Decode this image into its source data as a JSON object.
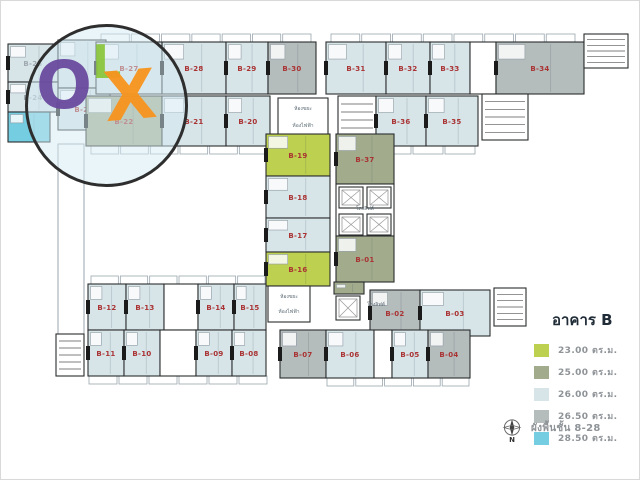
{
  "colors": {
    "sqm_23": "#bdd04f",
    "sqm_25": "#a2ac8d",
    "sqm_26": "#d7e5e9",
    "sqm_265": "#b5bcbc",
    "sqm_285": "#74cde1",
    "wall": "#2a2d2e",
    "unit_label_red": "#a93232",
    "unit_label_gray": "#9fa8b0",
    "tiny_text": "#5a6a74",
    "legend_text": "#8e9397",
    "legend_title": "#1f2b36",
    "olx_purple": "#6a4a9e",
    "olx_green": "#8cc63e",
    "olx_orange": "#f7941e",
    "background": "#ffffff"
  },
  "watermark": {
    "o": "O",
    "l": "L",
    "x": "X"
  },
  "legend": {
    "title": "อาคาร B",
    "items": [
      {
        "t": "23",
        "label": "23.00 ตร.ม."
      },
      {
        "t": "25",
        "label": "25.00 ตร.ม."
      },
      {
        "t": "26",
        "label": "26.00 ตร.ม."
      },
      {
        "t": "265",
        "label": "26.50 ตร.ม."
      },
      {
        "t": "285",
        "label": "28.50 ตร.ม."
      }
    ]
  },
  "footer": {
    "north": "N",
    "caption": "ผังพื้นชั้น 8-28"
  },
  "plan": {
    "units": [
      {
        "id": "B-25",
        "x": 8,
        "y": 44,
        "w": 50,
        "h": 38,
        "t": "26",
        "lc": "gray"
      },
      {
        "x": 58,
        "y": 40,
        "w": 48,
        "h": 48,
        "t": "26"
      },
      {
        "id": "B-24",
        "x": 8,
        "y": 82,
        "w": 50,
        "h": 30,
        "t": "26",
        "lc": "gray"
      },
      {
        "id": "B-23",
        "x": 58,
        "y": 88,
        "w": 52,
        "h": 42,
        "t": "26"
      },
      {
        "x": 8,
        "y": 112,
        "w": 42,
        "h": 30,
        "t": "285"
      },
      {
        "id": "B-27",
        "x": 96,
        "y": 42,
        "w": 66,
        "h": 52,
        "t": "26"
      },
      {
        "id": "B-28",
        "x": 162,
        "y": 42,
        "w": 64,
        "h": 52,
        "t": "26"
      },
      {
        "id": "B-29",
        "x": 226,
        "y": 42,
        "w": 42,
        "h": 52,
        "t": "26"
      },
      {
        "id": "B-30",
        "x": 268,
        "y": 42,
        "w": 48,
        "h": 52,
        "t": "265"
      },
      {
        "id": "B-31",
        "x": 326,
        "y": 42,
        "w": 60,
        "h": 52,
        "t": "26"
      },
      {
        "id": "B-32",
        "x": 386,
        "y": 42,
        "w": 44,
        "h": 52,
        "t": "26"
      },
      {
        "id": "B-33",
        "x": 430,
        "y": 42,
        "w": 40,
        "h": 52,
        "t": "26"
      },
      {
        "x": 470,
        "y": 42,
        "w": 26,
        "h": 52,
        "t": "room"
      },
      {
        "id": "B-34",
        "x": 496,
        "y": 42,
        "w": 88,
        "h": 52,
        "t": "265"
      },
      {
        "x": 584,
        "y": 34,
        "w": 44,
        "h": 34,
        "t": "stair"
      },
      {
        "id": "B-22",
        "x": 86,
        "y": 96,
        "w": 76,
        "h": 50,
        "t": "25"
      },
      {
        "id": "B-21",
        "x": 162,
        "y": 96,
        "w": 64,
        "h": 50,
        "t": "26"
      },
      {
        "id": "B-20",
        "x": 226,
        "y": 96,
        "w": 44,
        "h": 50,
        "t": "26"
      },
      {
        "x": 278,
        "y": 98,
        "w": 50,
        "h": 42,
        "t": "room"
      },
      {
        "x": 338,
        "y": 96,
        "w": 38,
        "h": 48,
        "t": "stair"
      },
      {
        "id": "B-36",
        "x": 376,
        "y": 96,
        "w": 50,
        "h": 50,
        "t": "26"
      },
      {
        "id": "B-35",
        "x": 426,
        "y": 96,
        "w": 52,
        "h": 50,
        "t": "26"
      },
      {
        "x": 482,
        "y": 94,
        "w": 46,
        "h": 46,
        "t": "stair"
      },
      {
        "id": "B-19",
        "x": 266,
        "y": 134,
        "w": 64,
        "h": 42,
        "t": "23"
      },
      {
        "id": "B-18",
        "x": 266,
        "y": 176,
        "w": 64,
        "h": 42,
        "t": "26"
      },
      {
        "id": "B-17",
        "x": 266,
        "y": 218,
        "w": 64,
        "h": 34,
        "t": "26"
      },
      {
        "id": "B-16",
        "x": 266,
        "y": 252,
        "w": 64,
        "h": 34,
        "t": "23"
      },
      {
        "x": 268,
        "y": 286,
        "w": 42,
        "h": 36,
        "t": "room"
      },
      {
        "id": "B-37",
        "x": 336,
        "y": 134,
        "w": 58,
        "h": 50,
        "t": "25"
      },
      {
        "x": 336,
        "y": 184,
        "w": 58,
        "h": 52,
        "t": "room"
      },
      {
        "x": 339,
        "y": 187,
        "w": 24,
        "h": 21,
        "t": "elev"
      },
      {
        "x": 367,
        "y": 187,
        "w": 24,
        "h": 21,
        "t": "elev"
      },
      {
        "x": 339,
        "y": 214,
        "w": 24,
        "h": 21,
        "t": "elev"
      },
      {
        "x": 367,
        "y": 214,
        "w": 24,
        "h": 21,
        "t": "elev"
      },
      {
        "id": "B-01",
        "x": 336,
        "y": 236,
        "w": 58,
        "h": 46,
        "t": "25"
      },
      {
        "x": 334,
        "y": 282,
        "w": 30,
        "h": 12,
        "t": "25"
      },
      {
        "x": 336,
        "y": 296,
        "w": 24,
        "h": 24,
        "t": "elev"
      },
      {
        "id": "B-12",
        "x": 88,
        "y": 284,
        "w": 38,
        "h": 46,
        "t": "26"
      },
      {
        "id": "B-13",
        "x": 126,
        "y": 284,
        "w": 38,
        "h": 46,
        "t": "26"
      },
      {
        "x": 164,
        "y": 284,
        "w": 34,
        "h": 46,
        "t": "room"
      },
      {
        "id": "B-14",
        "x": 198,
        "y": 284,
        "w": 36,
        "h": 46,
        "t": "26"
      },
      {
        "id": "B-15",
        "x": 234,
        "y": 284,
        "w": 32,
        "h": 46,
        "t": "26"
      },
      {
        "id": "B-02",
        "x": 370,
        "y": 290,
        "w": 50,
        "h": 46,
        "t": "265"
      },
      {
        "id": "B-03",
        "x": 420,
        "y": 290,
        "w": 70,
        "h": 46,
        "t": "26"
      },
      {
        "x": 494,
        "y": 288,
        "w": 32,
        "h": 38,
        "t": "stair"
      },
      {
        "x": 56,
        "y": 334,
        "w": 28,
        "h": 42,
        "t": "stair"
      },
      {
        "id": "B-11",
        "x": 88,
        "y": 330,
        "w": 36,
        "h": 46,
        "t": "26"
      },
      {
        "id": "B-10",
        "x": 124,
        "y": 330,
        "w": 36,
        "h": 46,
        "t": "26"
      },
      {
        "x": 160,
        "y": 330,
        "w": 36,
        "h": 46,
        "t": "room"
      },
      {
        "id": "B-09",
        "x": 196,
        "y": 330,
        "w": 36,
        "h": 46,
        "t": "26"
      },
      {
        "id": "B-08",
        "x": 232,
        "y": 330,
        "w": 34,
        "h": 46,
        "t": "26"
      },
      {
        "id": "B-07",
        "x": 280,
        "y": 330,
        "w": 46,
        "h": 48,
        "t": "265"
      },
      {
        "id": "B-06",
        "x": 326,
        "y": 330,
        "w": 48,
        "h": 48,
        "t": "26"
      },
      {
        "x": 374,
        "y": 330,
        "w": 18,
        "h": 48,
        "t": "room"
      },
      {
        "id": "B-05",
        "x": 392,
        "y": 330,
        "w": 36,
        "h": 48,
        "t": "26"
      },
      {
        "id": "B-04",
        "x": 428,
        "y": 330,
        "w": 42,
        "h": 48,
        "t": "265"
      }
    ],
    "strips": [
      {
        "x": 100,
        "y": 34,
        "w": 212,
        "n": 7
      },
      {
        "x": 330,
        "y": 34,
        "w": 246,
        "n": 8
      },
      {
        "x": 90,
        "y": 146,
        "w": 178,
        "n": 6
      },
      {
        "x": 380,
        "y": 146,
        "w": 96,
        "n": 3
      },
      {
        "x": 90,
        "y": 276,
        "w": 176,
        "n": 6
      },
      {
        "x": 88,
        "y": 376,
        "w": 180,
        "n": 6
      },
      {
        "x": 326,
        "y": 378,
        "w": 144,
        "n": 5
      }
    ],
    "outlines": [
      {
        "x": 58,
        "y": 144,
        "w": 26,
        "h": 192
      }
    ],
    "tiny_labels": [
      {
        "t": "ห้องขยะ",
        "x": 303,
        "y": 110
      },
      {
        "t": "ห้องไฟฟ้า",
        "x": 303,
        "y": 127
      },
      {
        "t": "โถงลิฟต์",
        "x": 365,
        "y": 210
      },
      {
        "t": "ห้องขยะ",
        "x": 289,
        "y": 298
      },
      {
        "t": "ห้องไฟฟ้า",
        "x": 289,
        "y": 313
      },
      {
        "t": "โถงลิฟต์",
        "x": 376,
        "y": 306
      }
    ]
  }
}
